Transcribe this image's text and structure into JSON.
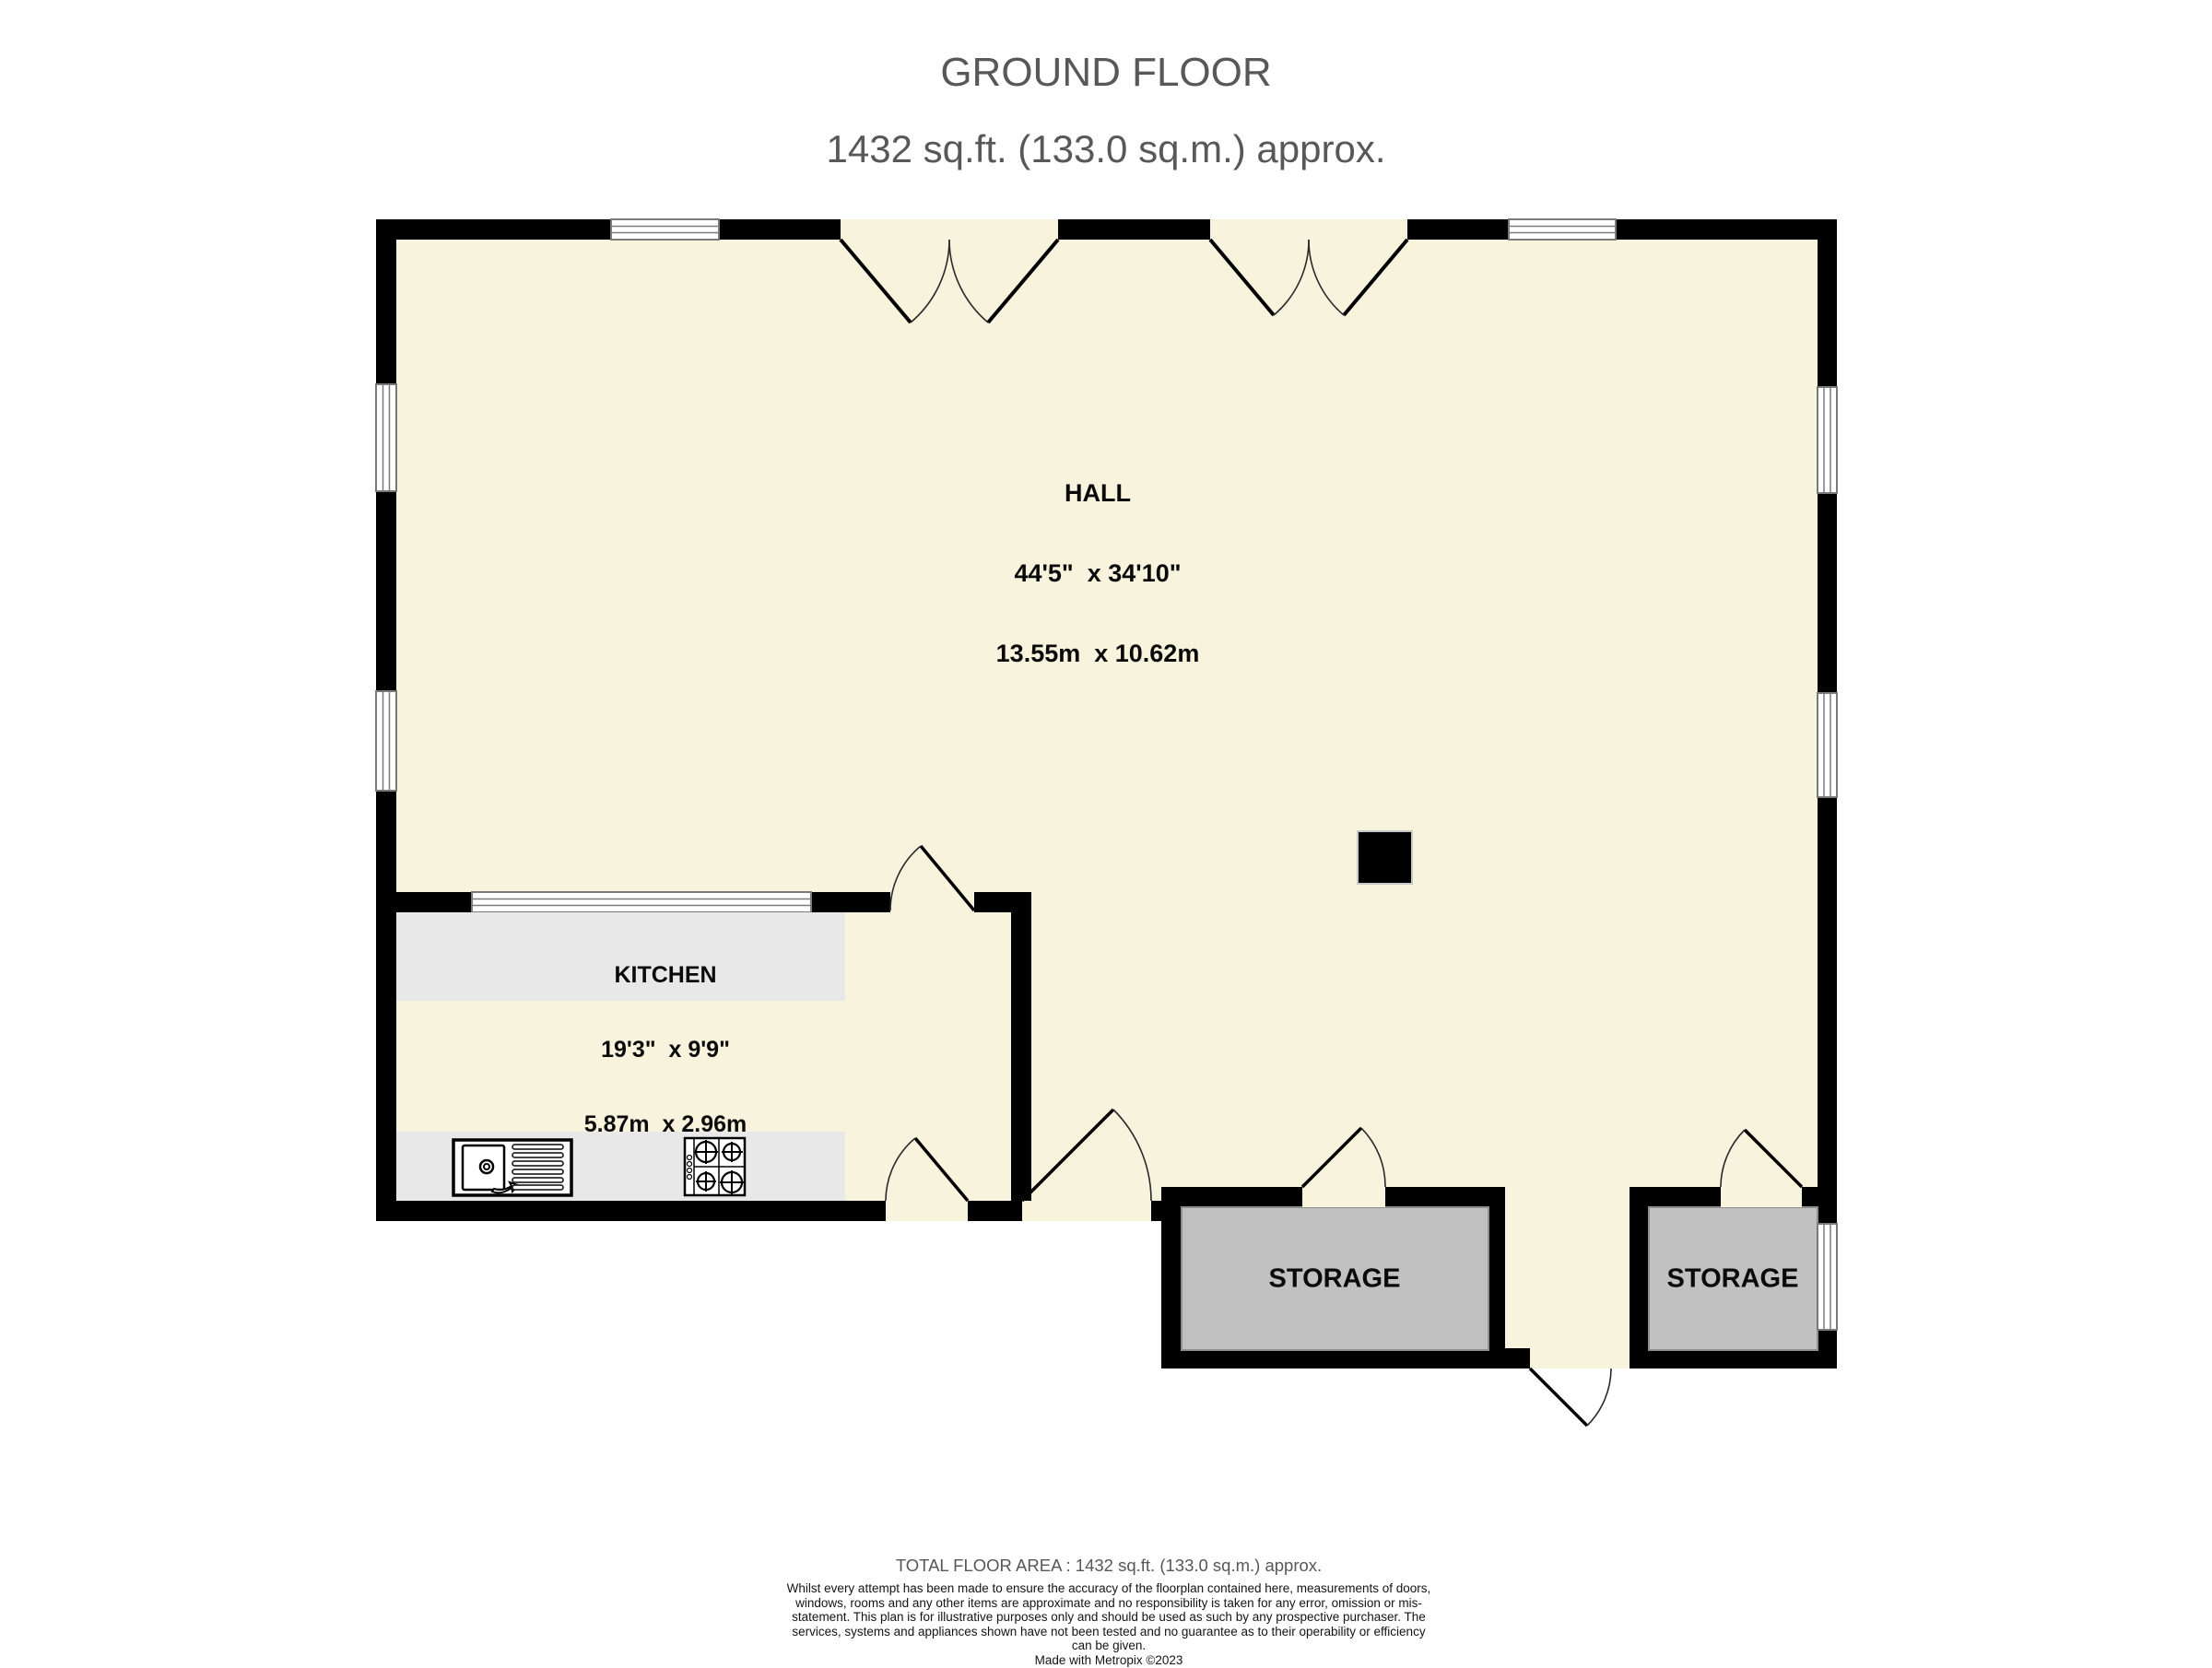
{
  "title": {
    "line1": "GROUND FLOOR",
    "line2": "1432 sq.ft. (133.0 sq.m.) approx."
  },
  "rooms": {
    "hall": {
      "name": "HALL",
      "dims_imperial": "44'5\"  x 34'10\"",
      "dims_metric": "13.55m  x 10.62m"
    },
    "kitchen": {
      "name": "KITCHEN",
      "dims_imperial": "19'3\"  x 9'9\"",
      "dims_metric": "5.87m  x 2.96m"
    },
    "storage1": {
      "name": "STORAGE"
    },
    "storage2": {
      "name": "STORAGE"
    }
  },
  "footer": {
    "total_area": "TOTAL FLOOR AREA : 1432 sq.ft. (133.0 sq.m.) approx.",
    "disclaimer": "Whilst every attempt has been made to ensure the accuracy of the floorplan contained here, measurements of doors, windows, rooms and any other items are approximate and no responsibility is taken for any error, omission or mis-statement. This plan is for illustrative purposes only and should be used as such by any prospective purchaser. The services, systems and appliances shown have not been tested and no guarantee as to their operability or efficiency can be given.",
    "credit": "Made with Metropix ©2023"
  },
  "colors": {
    "room_fill": "#F7F3DD",
    "wall": "#000000",
    "storage_fill": "#C1C1C1",
    "counter_fill": "#E8E8E8",
    "title_text": "#58585A",
    "window_line": "#7a7a7a"
  }
}
